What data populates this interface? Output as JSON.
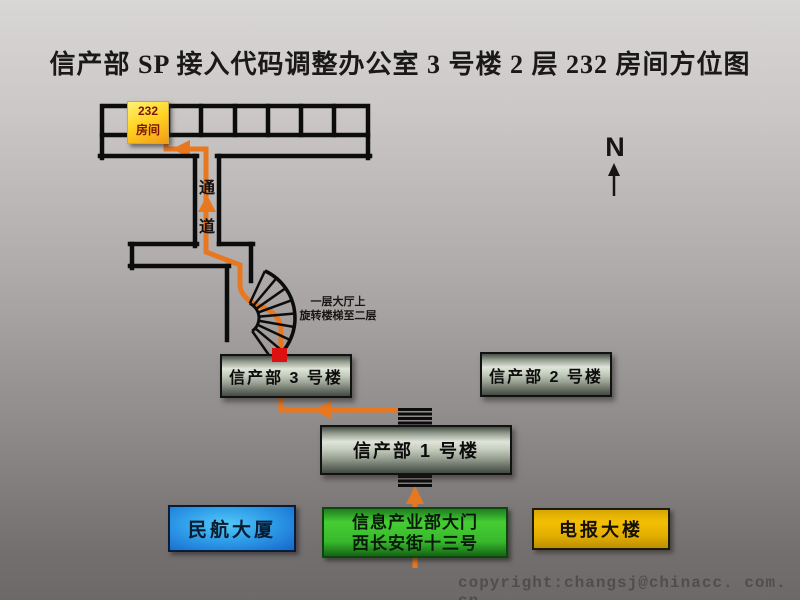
{
  "title": "信产部 SP 接入代码调整办公室 3 号楼 2 层 232 房间方位图",
  "compass": {
    "label": "N"
  },
  "floor2": {
    "room_badge": {
      "number": "232",
      "label": "房间"
    },
    "corridor_label": {
      "char1": "通",
      "char2": "道"
    },
    "stair_note": {
      "line1": "一层大厅上",
      "line2": "旋转楼梯至二层"
    }
  },
  "buildings": {
    "building3": "信产部 3 号楼",
    "building2": "信产部 2 号楼",
    "building1": "信产部 1 号楼",
    "caac": "民航大厦",
    "gate_line1": "信息产业部大门",
    "gate_line2": "西长安街十三号",
    "telegraph": "电报大楼"
  },
  "copyright": "copyright:changsj@chinacc. com. cn",
  "colors": {
    "route_orange": "#e87820",
    "wall_black": "#0c0c0c",
    "room_highlight_yellow": "#ffd322",
    "entrance_red": "#dd1111",
    "building_metal_light": "#dfe5d8",
    "caac_blue": "#2e9ce8",
    "gate_green": "#38b82c",
    "telegraph_gold": "#e8b400"
  }
}
